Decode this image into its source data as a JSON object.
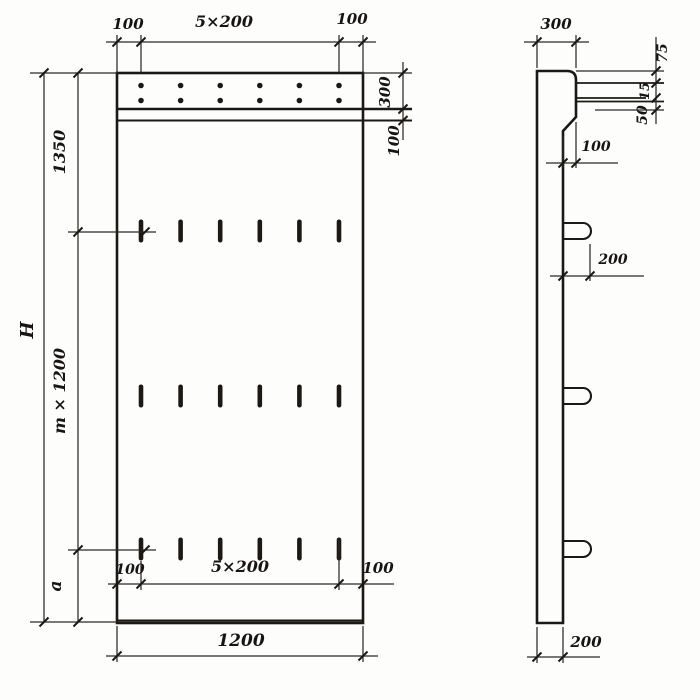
{
  "drawing": {
    "front_view": {
      "top_dim": {
        "left": "100",
        "center": "5×200",
        "right": "100"
      },
      "right_dim": {
        "band": "300",
        "strip": "100"
      },
      "left_dim": {
        "overall": "H",
        "upper": "1350",
        "middle": "m × 1200",
        "lower": "a"
      },
      "bottom_inner_dim": {
        "left": "100",
        "center": "5×200",
        "right": "100"
      },
      "bottom_dim": {
        "overall": "1200"
      }
    },
    "side_view": {
      "top_dim": "300",
      "edge_dims": {
        "first": "75",
        "second": "15",
        "third": "50"
      },
      "step_dim": "100",
      "loop_dim": "200",
      "bottom_dim": "200"
    }
  }
}
